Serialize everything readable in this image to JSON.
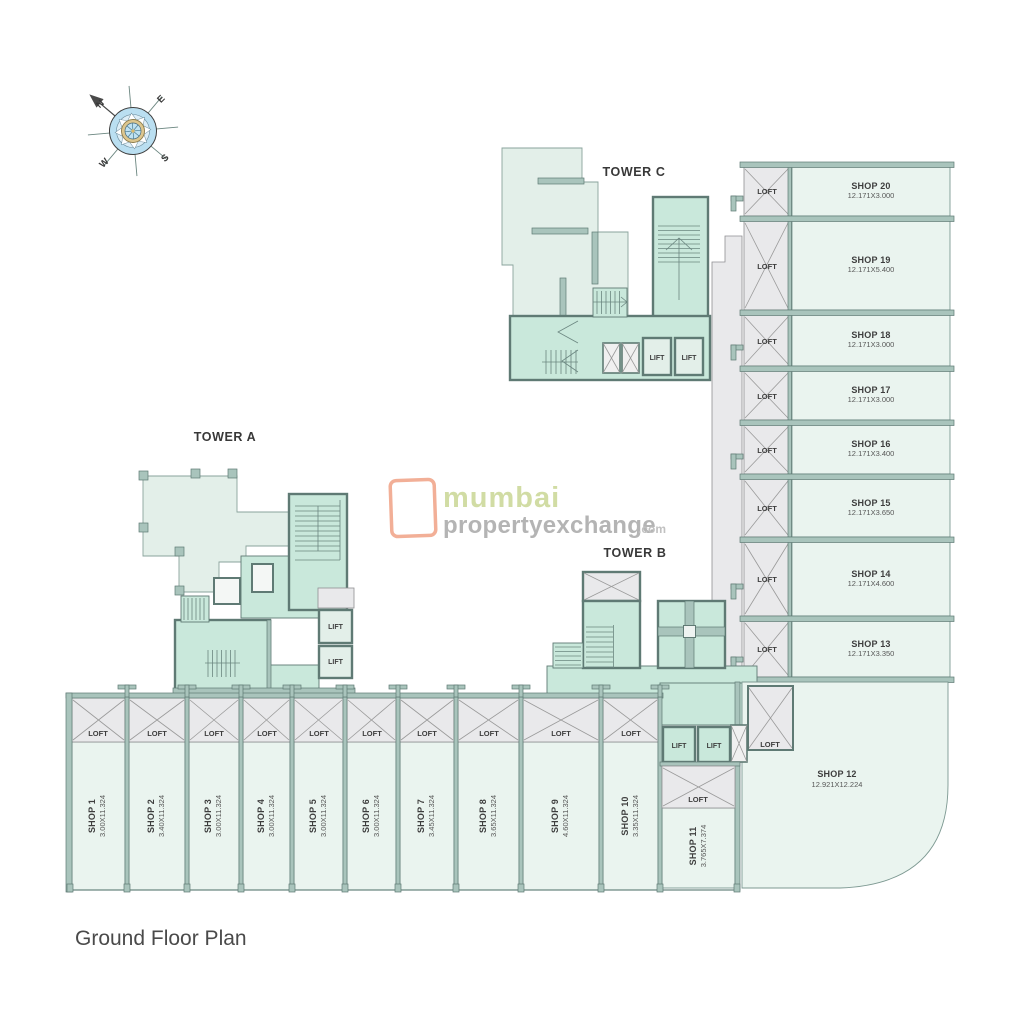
{
  "page": {
    "title": "Ground Floor Plan"
  },
  "compass": {
    "n": "N",
    "e": "E",
    "s": "S",
    "w": "W"
  },
  "towers": {
    "a": "TOWER A",
    "b": "TOWER B",
    "c": "TOWER C"
  },
  "labels": {
    "loft": "LOFT",
    "lift": "LIFT"
  },
  "watermark": {
    "name": "mumbai",
    "domain": "propertyexchange",
    "tld": ".com"
  },
  "right_shops": [
    {
      "name": "SHOP 20",
      "dims": "12.171X3.000"
    },
    {
      "name": "SHOP 19",
      "dims": "12.171X5.400"
    },
    {
      "name": "SHOP 18",
      "dims": "12.171X3.000"
    },
    {
      "name": "SHOP 17",
      "dims": "12.171X3.000"
    },
    {
      "name": "SHOP 16",
      "dims": "12.171X3.400"
    },
    {
      "name": "SHOP 15",
      "dims": "12.171X3.650"
    },
    {
      "name": "SHOP 14",
      "dims": "12.171X4.600"
    },
    {
      "name": "SHOP 13",
      "dims": "12.171X3.350"
    }
  ],
  "bottom_shops": [
    {
      "name": "SHOP 1",
      "dims": "3.00X11.324"
    },
    {
      "name": "SHOP 2",
      "dims": "3.40X11.324"
    },
    {
      "name": "SHOP 3",
      "dims": "3.00X11.324"
    },
    {
      "name": "SHOP 4",
      "dims": "3.00X11.324"
    },
    {
      "name": "SHOP 5",
      "dims": "3.00X11.324"
    },
    {
      "name": "SHOP 6",
      "dims": "3.00X11.324"
    },
    {
      "name": "SHOP 7",
      "dims": "3.45X11.324"
    },
    {
      "name": "SHOP 8",
      "dims": "3.65X11.324"
    },
    {
      "name": "SHOP 9",
      "dims": "4.60X11.324"
    },
    {
      "name": "SHOP 10",
      "dims": "3.35X11.324"
    },
    {
      "name": "SHOP 11",
      "dims": "3.765X7.374"
    }
  ],
  "shop12": {
    "name": "SHOP 12",
    "dims": "12.921X12.224"
  },
  "colors": {
    "wall": "#a9c4bc",
    "teal_room": "#c9e8db",
    "pale_room": "#e3efe9",
    "shop_fill": "#eaf4ef",
    "loft_fill": "#e9e9eb",
    "watermark_box": "#f0a285",
    "watermark_green": "#c9d795",
    "watermark_gray": "#a8a8a8"
  }
}
